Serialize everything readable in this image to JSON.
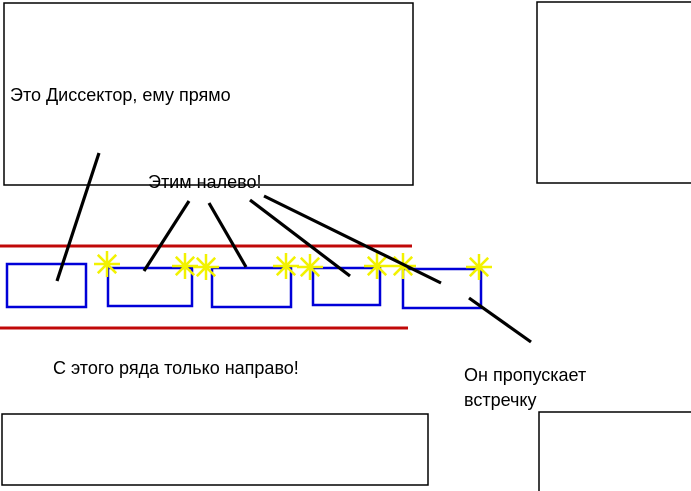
{
  "colors": {
    "background": "#ffffff",
    "road_line": "#c00808",
    "car_outline": "#0000d8",
    "turn_signal": "#f2f200",
    "pointer_line": "#000000",
    "building_outline": "#000000"
  },
  "annotations": {
    "straight_car": "Это Диссектор, ему прямо",
    "left_turn_cars": "Этим налево!",
    "right_only_lane": "С этого ряда только направо!",
    "yielding_car": "Он пропускает\nвстречку"
  },
  "diagram": {
    "buildings": [
      {
        "name": "building-top-left",
        "x": 4,
        "y": 3,
        "w": 409,
        "h": 182
      },
      {
        "name": "building-top-right",
        "x": 537,
        "y": 2,
        "w": 162,
        "h": 181
      },
      {
        "name": "building-bottom-left",
        "x": 2,
        "y": 414,
        "w": 426,
        "h": 71
      },
      {
        "name": "building-bottom-right",
        "x": 539,
        "y": 412,
        "w": 160,
        "h": 87
      }
    ],
    "road_edges": [
      {
        "name": "road-edge-top",
        "x1": 0,
        "y1": 246,
        "x2": 412,
        "y2": 246
      },
      {
        "name": "road-edge-bottom",
        "x1": 0,
        "y1": 328,
        "x2": 408,
        "y2": 328
      }
    ],
    "cars": [
      {
        "name": "car-1",
        "x": 7,
        "y": 264,
        "w": 79,
        "h": 43
      },
      {
        "name": "car-2",
        "x": 108,
        "y": 268,
        "w": 84,
        "h": 38
      },
      {
        "name": "car-3",
        "x": 212,
        "y": 268,
        "w": 79,
        "h": 39
      },
      {
        "name": "car-4",
        "x": 313,
        "y": 268,
        "w": 67,
        "h": 37
      },
      {
        "name": "car-5",
        "x": 403,
        "y": 269,
        "w": 78,
        "h": 39
      }
    ],
    "turn_signals": [
      {
        "cx": 107,
        "cy": 264
      },
      {
        "cx": 185,
        "cy": 266
      },
      {
        "cx": 206,
        "cy": 267
      },
      {
        "cx": 286,
        "cy": 266
      },
      {
        "cx": 310,
        "cy": 267
      },
      {
        "cx": 377,
        "cy": 266
      },
      {
        "cx": 403,
        "cy": 266
      },
      {
        "cx": 479,
        "cy": 267
      }
    ],
    "pointer_lines": [
      {
        "name": "pointer-to-car-1",
        "x1": 99,
        "y1": 153,
        "x2": 57,
        "y2": 281
      },
      {
        "name": "pointer-to-car-2",
        "x1": 189,
        "y1": 201,
        "x2": 144,
        "y2": 271
      },
      {
        "name": "pointer-to-car-3",
        "x1": 209,
        "y1": 203,
        "x2": 246,
        "y2": 267
      },
      {
        "name": "pointer-to-car-4",
        "x1": 250,
        "y1": 200,
        "x2": 350,
        "y2": 276
      },
      {
        "name": "pointer-to-car-5",
        "x1": 264,
        "y1": 196,
        "x2": 441,
        "y2": 283
      },
      {
        "name": "pointer-to-yield-note",
        "x1": 469,
        "y1": 298,
        "x2": 531,
        "y2": 342
      }
    ]
  }
}
